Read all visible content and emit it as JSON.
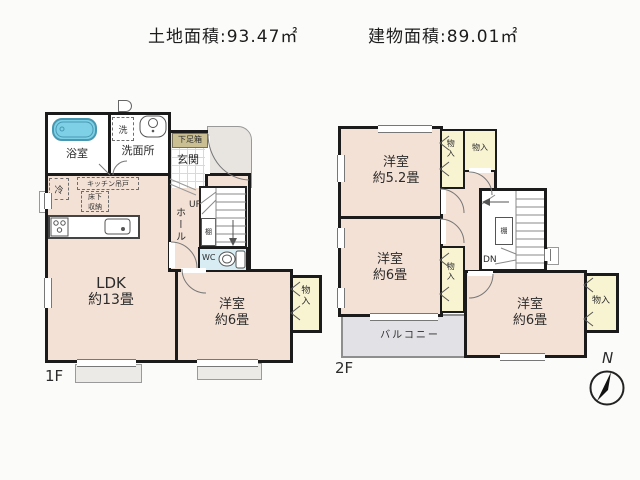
{
  "header": {
    "land_area": "土地面積:93.47㎡",
    "building_area": "建物面積:89.01㎡"
  },
  "floor1": {
    "label": "1F",
    "bathroom": "浴室",
    "washer": "洗",
    "washroom": "洗面所",
    "shoe_cabinet": "下足箱",
    "entrance": "玄関",
    "fridge": "冷",
    "kitchen_cupboard": "キッチン吊戸",
    "underfloor_line1": "床下",
    "underfloor_line2": "収納",
    "up": "UP",
    "hall": "ホール",
    "shelf": "棚",
    "wc": "WC",
    "ldk_line1": "LDK",
    "ldk_line2": "約13畳",
    "bedroom_line1": "洋室",
    "bedroom_line2": "約6畳",
    "closet": "物入"
  },
  "floor2": {
    "label": "2F",
    "bedroom52_line1": "洋室",
    "bedroom52_line2": "約5.2畳",
    "closet_a": "物入",
    "closet_b": "物入",
    "shelf": "棚",
    "dn": "DN",
    "bedroom6l_line1": "洋室",
    "bedroom6l_line2": "約6畳",
    "closet_c": "物入",
    "balcony": "バルコニー",
    "bedroom6r_line1": "洋室",
    "bedroom6r_line2": "約6畳",
    "closet_d": "物入"
  },
  "compass": {
    "north": "N"
  },
  "colors": {
    "wall": "#1b1b1b",
    "floor": "#f3e1d5",
    "closet": "#f8f4d2",
    "balcony": "#e2e2e6",
    "wc": "#d8edf3",
    "bathtub": "#7ed0e6",
    "shoe_label_bg": "#c9bf92"
  }
}
